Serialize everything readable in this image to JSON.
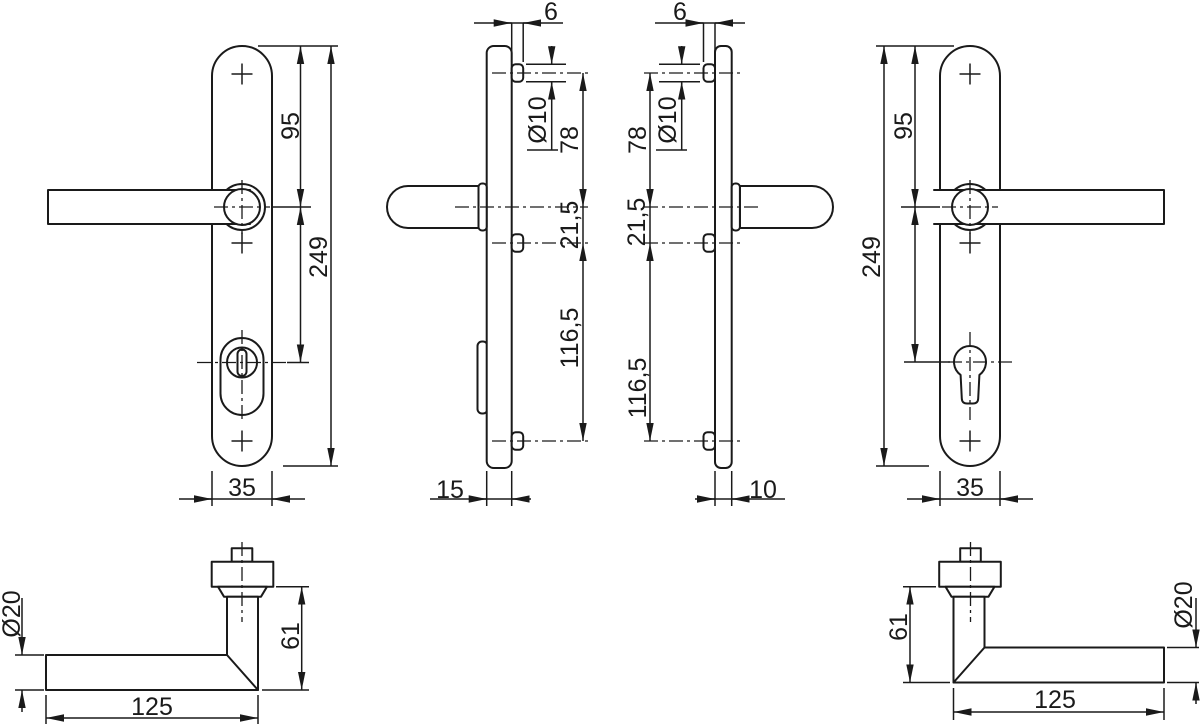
{
  "drawing": {
    "type": "technical-drawing",
    "subject": "door-handle-security-fitting",
    "background": "#ffffff",
    "line_color": "#1a1a1a",
    "views": {
      "front_left": {
        "total_height": "249",
        "handle_center_from_top": "95",
        "plate_width": "35"
      },
      "side_inner": {
        "stud_projection": "6",
        "stud_diameter": "Ø10",
        "stud_to_handle": "78",
        "handle_to_stud": "21,5",
        "stud_spacing": "116,5",
        "plate_depth": "15"
      },
      "side_outer": {
        "stud_projection": "6",
        "stud_diameter": "Ø10",
        "stud_to_handle": "78",
        "handle_to_stud": "21,5",
        "stud_spacing": "116,5",
        "plate_depth": "10"
      },
      "front_right": {
        "total_height": "249",
        "handle_center_from_top": "95",
        "plate_width": "35"
      },
      "lever_left": {
        "grip_diameter": "Ø20",
        "lever_height": "61",
        "lever_length": "125"
      },
      "lever_right": {
        "grip_diameter": "Ø20",
        "lever_height": "61",
        "lever_length": "125"
      }
    }
  }
}
